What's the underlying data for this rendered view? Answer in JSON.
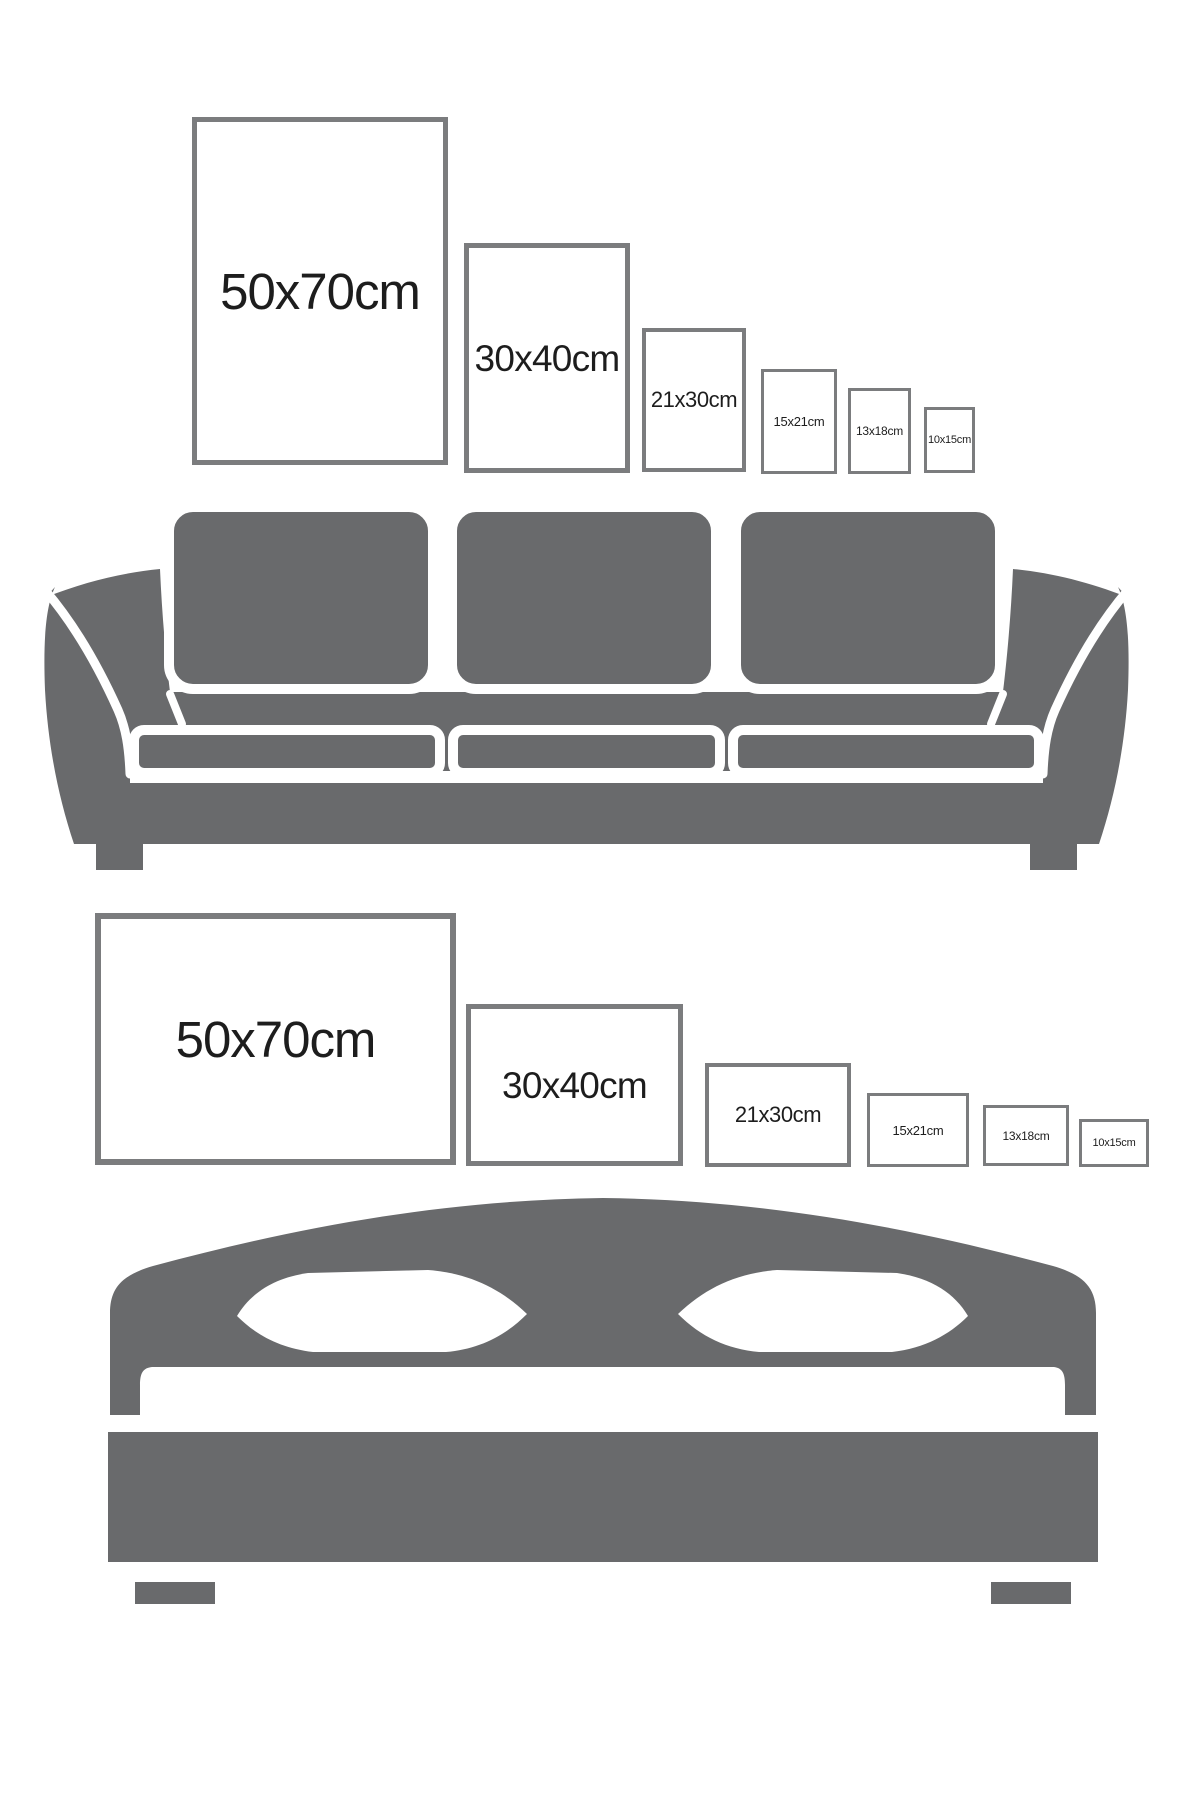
{
  "colors": {
    "furniture_gray": "#696a6c",
    "frame_border": "#7b7c7e",
    "label_text": "#1d1d1d",
    "background": "#ffffff"
  },
  "sections": [
    {
      "id": "wall-above-sofa",
      "furniture": "sofa",
      "furniture_icon": "sofa-icon",
      "frame_orientation": "portrait",
      "frames": [
        {
          "label": "50x70cm",
          "width_cm": 50,
          "height_cm": 70
        },
        {
          "label": "30x40cm",
          "width_cm": 30,
          "height_cm": 40
        },
        {
          "label": "21x30cm",
          "width_cm": 21,
          "height_cm": 30
        },
        {
          "label": "15x21cm",
          "width_cm": 15,
          "height_cm": 21
        },
        {
          "label": "13x18cm",
          "width_cm": 13,
          "height_cm": 18
        },
        {
          "label": "10x15cm",
          "width_cm": 10,
          "height_cm": 15
        }
      ]
    },
    {
      "id": "wall-above-bed",
      "furniture": "bed",
      "furniture_icon": "bed-icon",
      "frame_orientation": "landscape",
      "frames": [
        {
          "label": "50x70cm",
          "width_cm": 70,
          "height_cm": 50
        },
        {
          "label": "30x40cm",
          "width_cm": 40,
          "height_cm": 30
        },
        {
          "label": "21x30cm",
          "width_cm": 30,
          "height_cm": 21
        },
        {
          "label": "15x21cm",
          "width_cm": 21,
          "height_cm": 15
        },
        {
          "label": "13x18cm",
          "width_cm": 18,
          "height_cm": 13
        },
        {
          "label": "10x15cm",
          "width_cm": 15,
          "height_cm": 10
        }
      ]
    }
  ]
}
